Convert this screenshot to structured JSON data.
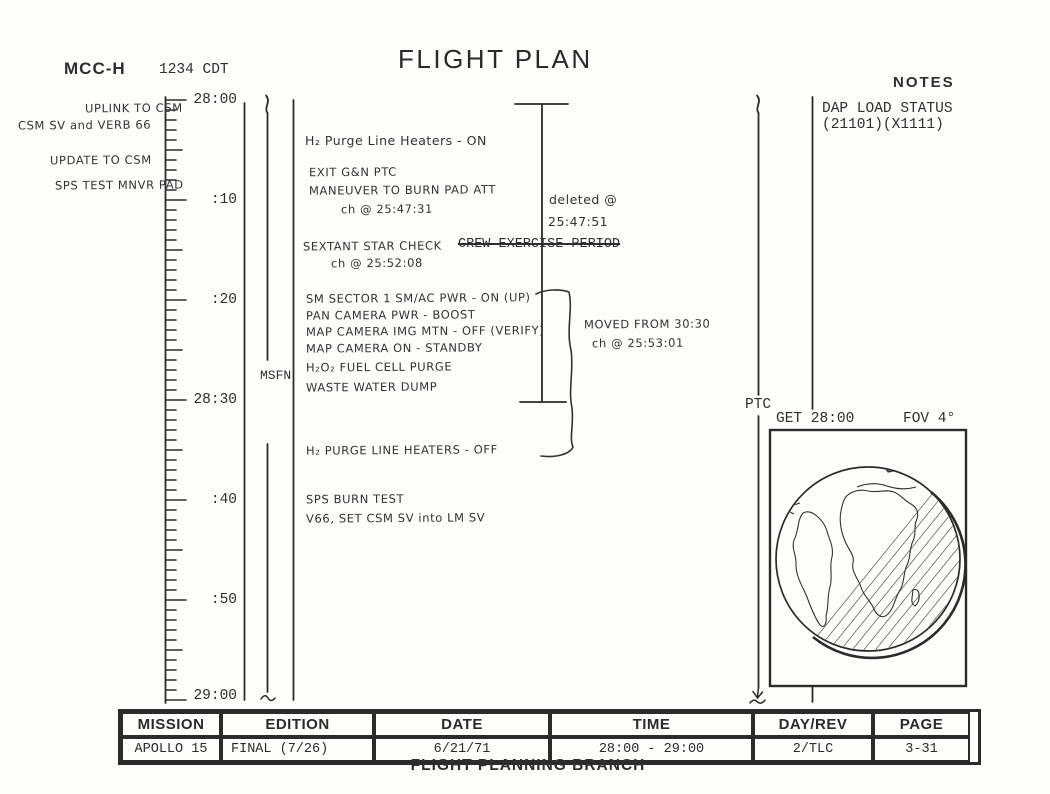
{
  "title": "FLIGHT PLAN",
  "colors": {
    "ink": "#2b2b2b",
    "paper": "#fdfdfc"
  },
  "mcch": {
    "title": "MCC-H",
    "time": "1234 CDT",
    "note1_line1": "UPLINK TO CSM",
    "note1_line2": "CSM SV and VERB 66",
    "note2_line1": "UPDATE TO CSM",
    "note2_line2": "SPS TEST MNVR PAD"
  },
  "timeline": {
    "labels": [
      "28:00",
      ":10",
      ":20",
      "28:30",
      ":40",
      ":50",
      "29:00"
    ],
    "coverage": "MSFN"
  },
  "activities": {
    "b1": [
      "H₂ Purge Line Heaters - ON",
      "EXIT G&N PTC",
      "MANEUVER TO BURN PAD ATT",
      "ch @ 25:47:31"
    ],
    "b2": [
      "SEXTANT STAR CHECK",
      "ch @ 25:52:08"
    ],
    "b2_deleted": "CREW EXERCISE PERIOD",
    "b3": [
      "SM SECTOR 1 SM/AC PWR - ON (UP)",
      "PAN CAMERA PWR - BOOST",
      "MAP CAMERA IMG MTN - OFF (VERIFY)",
      "MAP CAMERA ON - STANDBY",
      "H₂O₂ FUEL CELL PURGE",
      "WASTE WATER DUMP"
    ],
    "b4": [
      "H₂ PURGE LINE HEATERS - OFF"
    ],
    "b5": [
      "SPS BURN TEST",
      "V66, SET CSM SV into LM SV"
    ]
  },
  "annotations": {
    "deleted1": "deleted @",
    "deleted2": "25:47:51",
    "moved1": "MOVED FROM 30:30",
    "moved2": "ch @ 25:53:01"
  },
  "notes": {
    "title": "NOTES",
    "dap1": "DAP LOAD STATUS",
    "dap2": "(21101)(X1111)",
    "ptc": "PTC",
    "globe_get": "GET 28:00",
    "globe_fov": "FOV 4°"
  },
  "footer": {
    "headers": [
      "MISSION",
      "EDITION",
      "DATE",
      "TIME",
      "DAY/REV",
      "PAGE"
    ],
    "values": [
      "APOLLO 15",
      "FINAL (7/26)",
      "6/21/71",
      "28:00 - 29:00",
      "2/TLC",
      "3-31"
    ],
    "branch": "FLIGHT PLANNING BRANCH"
  }
}
